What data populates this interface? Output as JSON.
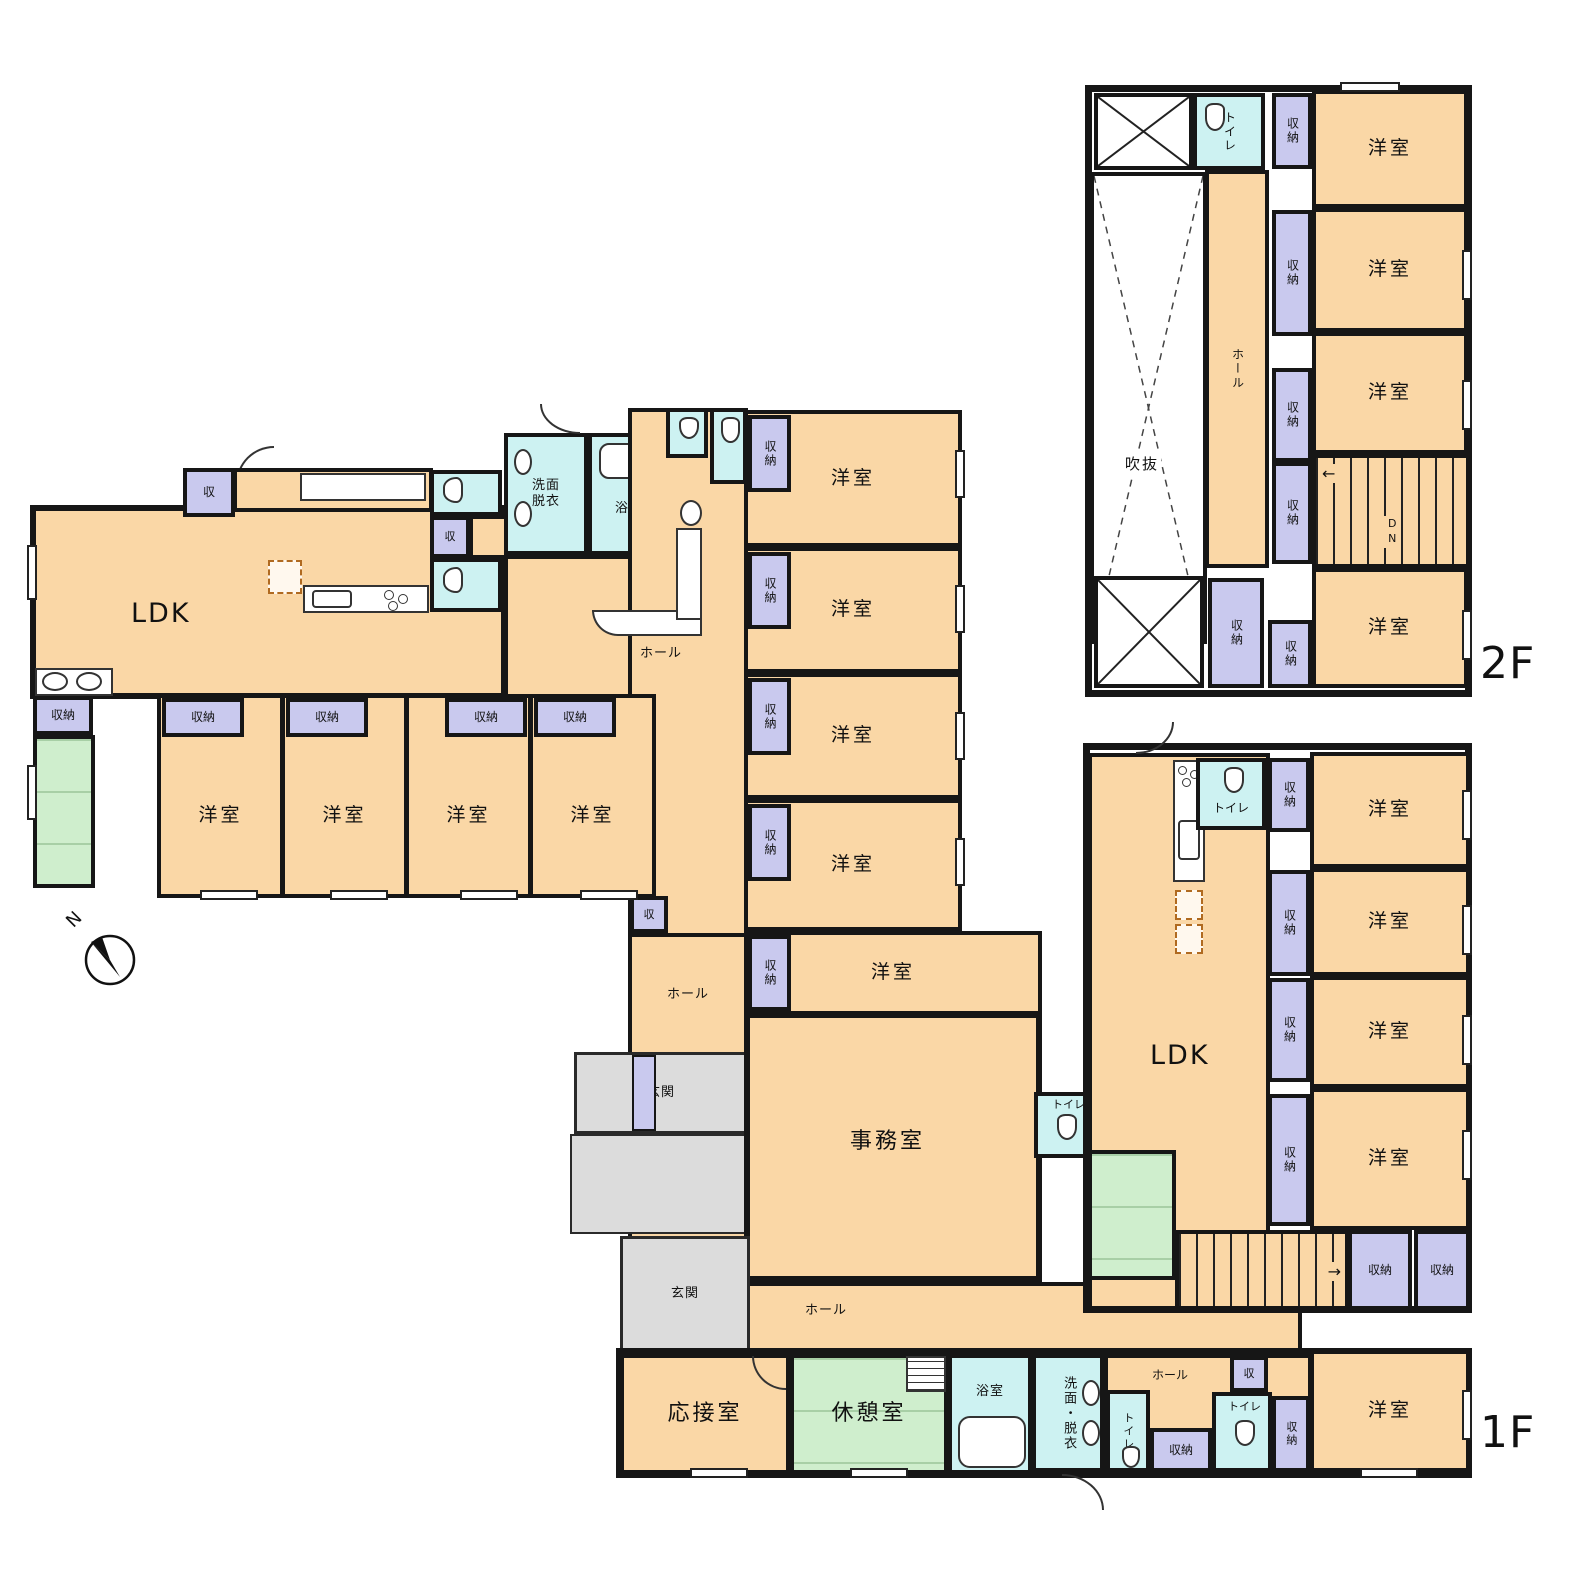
{
  "misc": {
    "north": "N"
  },
  "f2": {
    "floor_label": "2F",
    "toilet": "トイレ",
    "void": "吹抜",
    "hall": "ホール",
    "rooms": [
      {
        "c": "収納",
        "n": "洋室"
      },
      {
        "c": "収納",
        "n": "洋室"
      },
      {
        "c": "収納",
        "n": "洋室"
      },
      {
        "c": "収納",
        "n": "洋室"
      }
    ],
    "stair_closet": "収納",
    "stairs_dn": "DN",
    "closet_big": "収納"
  },
  "l": {
    "closet_entry": "収",
    "ldk": "LDK",
    "closet_kitchen": "収",
    "washroom": "洗面脱衣",
    "bath": "浴室",
    "hall": "ホール",
    "sink_closet": "収納",
    "rooms": [
      {
        "c": "収納",
        "n": "洋室"
      },
      {
        "c": "収納",
        "n": "洋室"
      },
      {
        "c": "収納",
        "n": "洋室"
      },
      {
        "c": "収納",
        "n": "洋室"
      }
    ]
  },
  "ct": {
    "rooms": [
      {
        "c": "収納",
        "n": "洋室"
      },
      {
        "c": "収納",
        "n": "洋室"
      },
      {
        "c": "収納",
        "n": "洋室"
      },
      {
        "c": "収納",
        "n": "洋室"
      },
      {
        "c": "収納",
        "n": "洋室"
      }
    ],
    "closet_hall": "収",
    "hall_small": "ホール",
    "entrance_upper": "玄関",
    "entrance_lower": "玄関",
    "office": "事務室",
    "office_toilet": "トイレ",
    "hall_bottom": "ホール"
  },
  "rt": {
    "toilet": "トイレ",
    "ldk": "LDK",
    "rooms": [
      {
        "c": "収納",
        "n": "洋室"
      },
      {
        "c": "収納",
        "n": "洋室"
      },
      {
        "c": "収納",
        "n": "洋室"
      },
      {
        "c": "収納",
        "n": "洋室"
      }
    ],
    "stair_closets": [
      "収納",
      "収納"
    ]
  },
  "b": {
    "floor_label": "1F",
    "reception": "応接室",
    "break_room": "休憩室",
    "bath": "浴室",
    "washroom": "洗面・脱衣",
    "toilet_left": "トイレ",
    "closet_left": "収納",
    "hall": "ホール",
    "closet_mini": "収",
    "toilet_right": "トイレ",
    "closet_vert": "収納",
    "room": "洋室"
  }
}
